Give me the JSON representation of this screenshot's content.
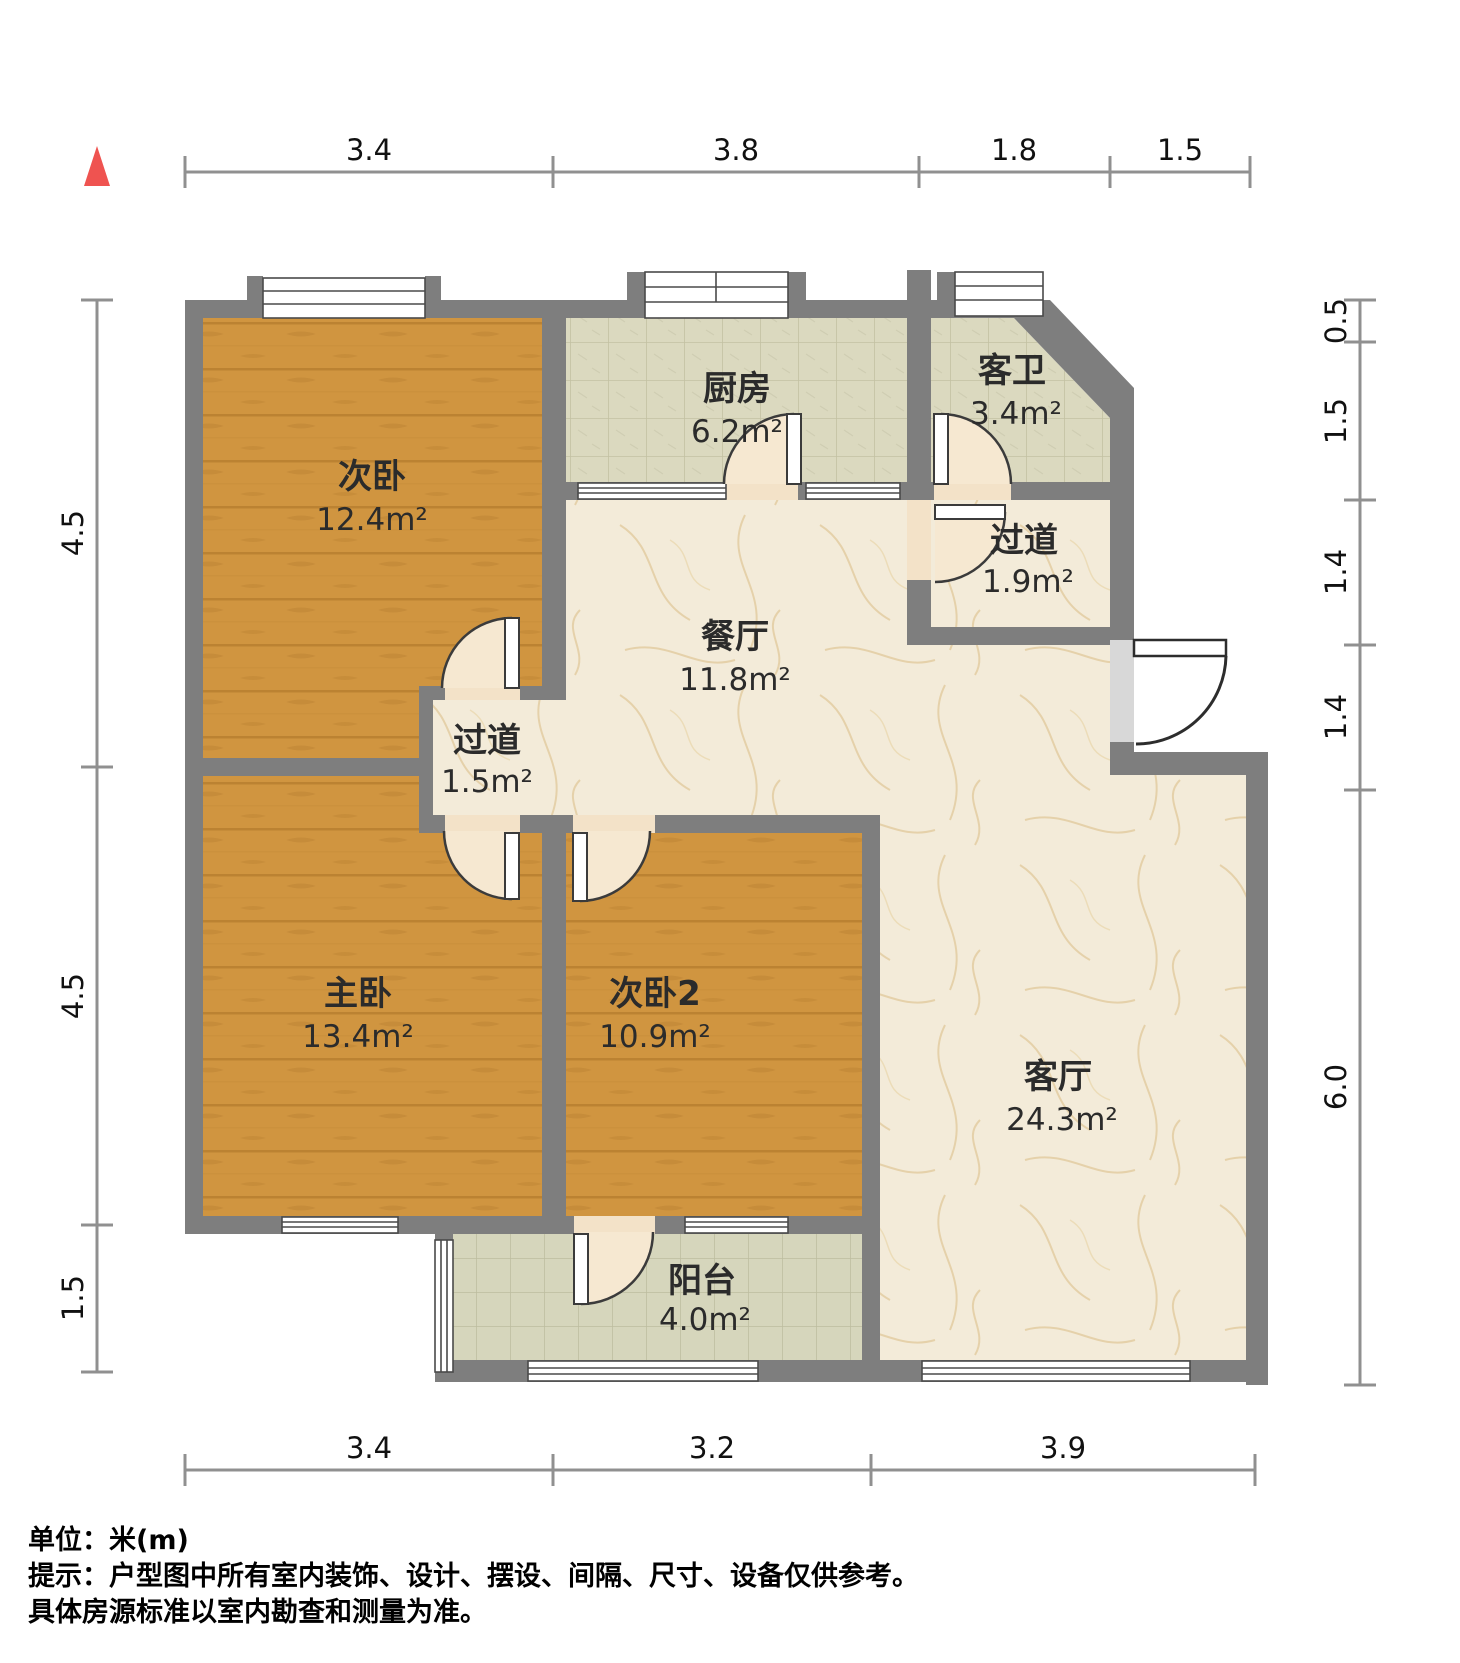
{
  "plan": {
    "type": "apartment-floorplan",
    "unit": "米(m)"
  },
  "rooms": [
    {
      "id": "bedroom2",
      "name": "次卧",
      "area": "12.4m²"
    },
    {
      "id": "kitchen",
      "name": "厨房",
      "area": "6.2m²"
    },
    {
      "id": "guestbath",
      "name": "客卫",
      "area": "3.4m²"
    },
    {
      "id": "hallway-a",
      "name": "过道",
      "area": "1.9m²"
    },
    {
      "id": "dining",
      "name": "餐厅",
      "area": "11.8m²"
    },
    {
      "id": "hallway-b",
      "name": "过道",
      "area": "1.5m²"
    },
    {
      "id": "master",
      "name": "主卧",
      "area": "13.4m²"
    },
    {
      "id": "bedroom3",
      "name": "次卧2",
      "area": "10.9m²"
    },
    {
      "id": "living",
      "name": "客厅",
      "area": "24.3m²"
    },
    {
      "id": "balcony",
      "name": "阳台",
      "area": "4.0m²"
    }
  ],
  "dimensions": {
    "top": [
      "3.4",
      "3.8",
      "1.8",
      "1.5"
    ],
    "bottom": [
      "3.4",
      "3.2",
      "3.9"
    ],
    "left": [
      "4.5",
      "4.5",
      "1.5"
    ],
    "right": [
      "0.5",
      "1.5",
      "1.4",
      "1.4",
      "6.0"
    ]
  },
  "footer": {
    "line1": "单位：米(m)",
    "line2": "提示：户型图中所有室内装饰、设计、摆设、间隔、尺寸、设备仅供参考。",
    "line3": "具体房源标准以室内勘查和测量为准。"
  },
  "colors": {
    "wall": "#7e7e7e",
    "wood_floor": "#d09540",
    "tile_floor": "#dbd9bf",
    "marble_floor": "#f3ebd9",
    "door_swing": "#f6e8d1",
    "north_arrow": "#ef5350",
    "dim_line": "#909090"
  }
}
